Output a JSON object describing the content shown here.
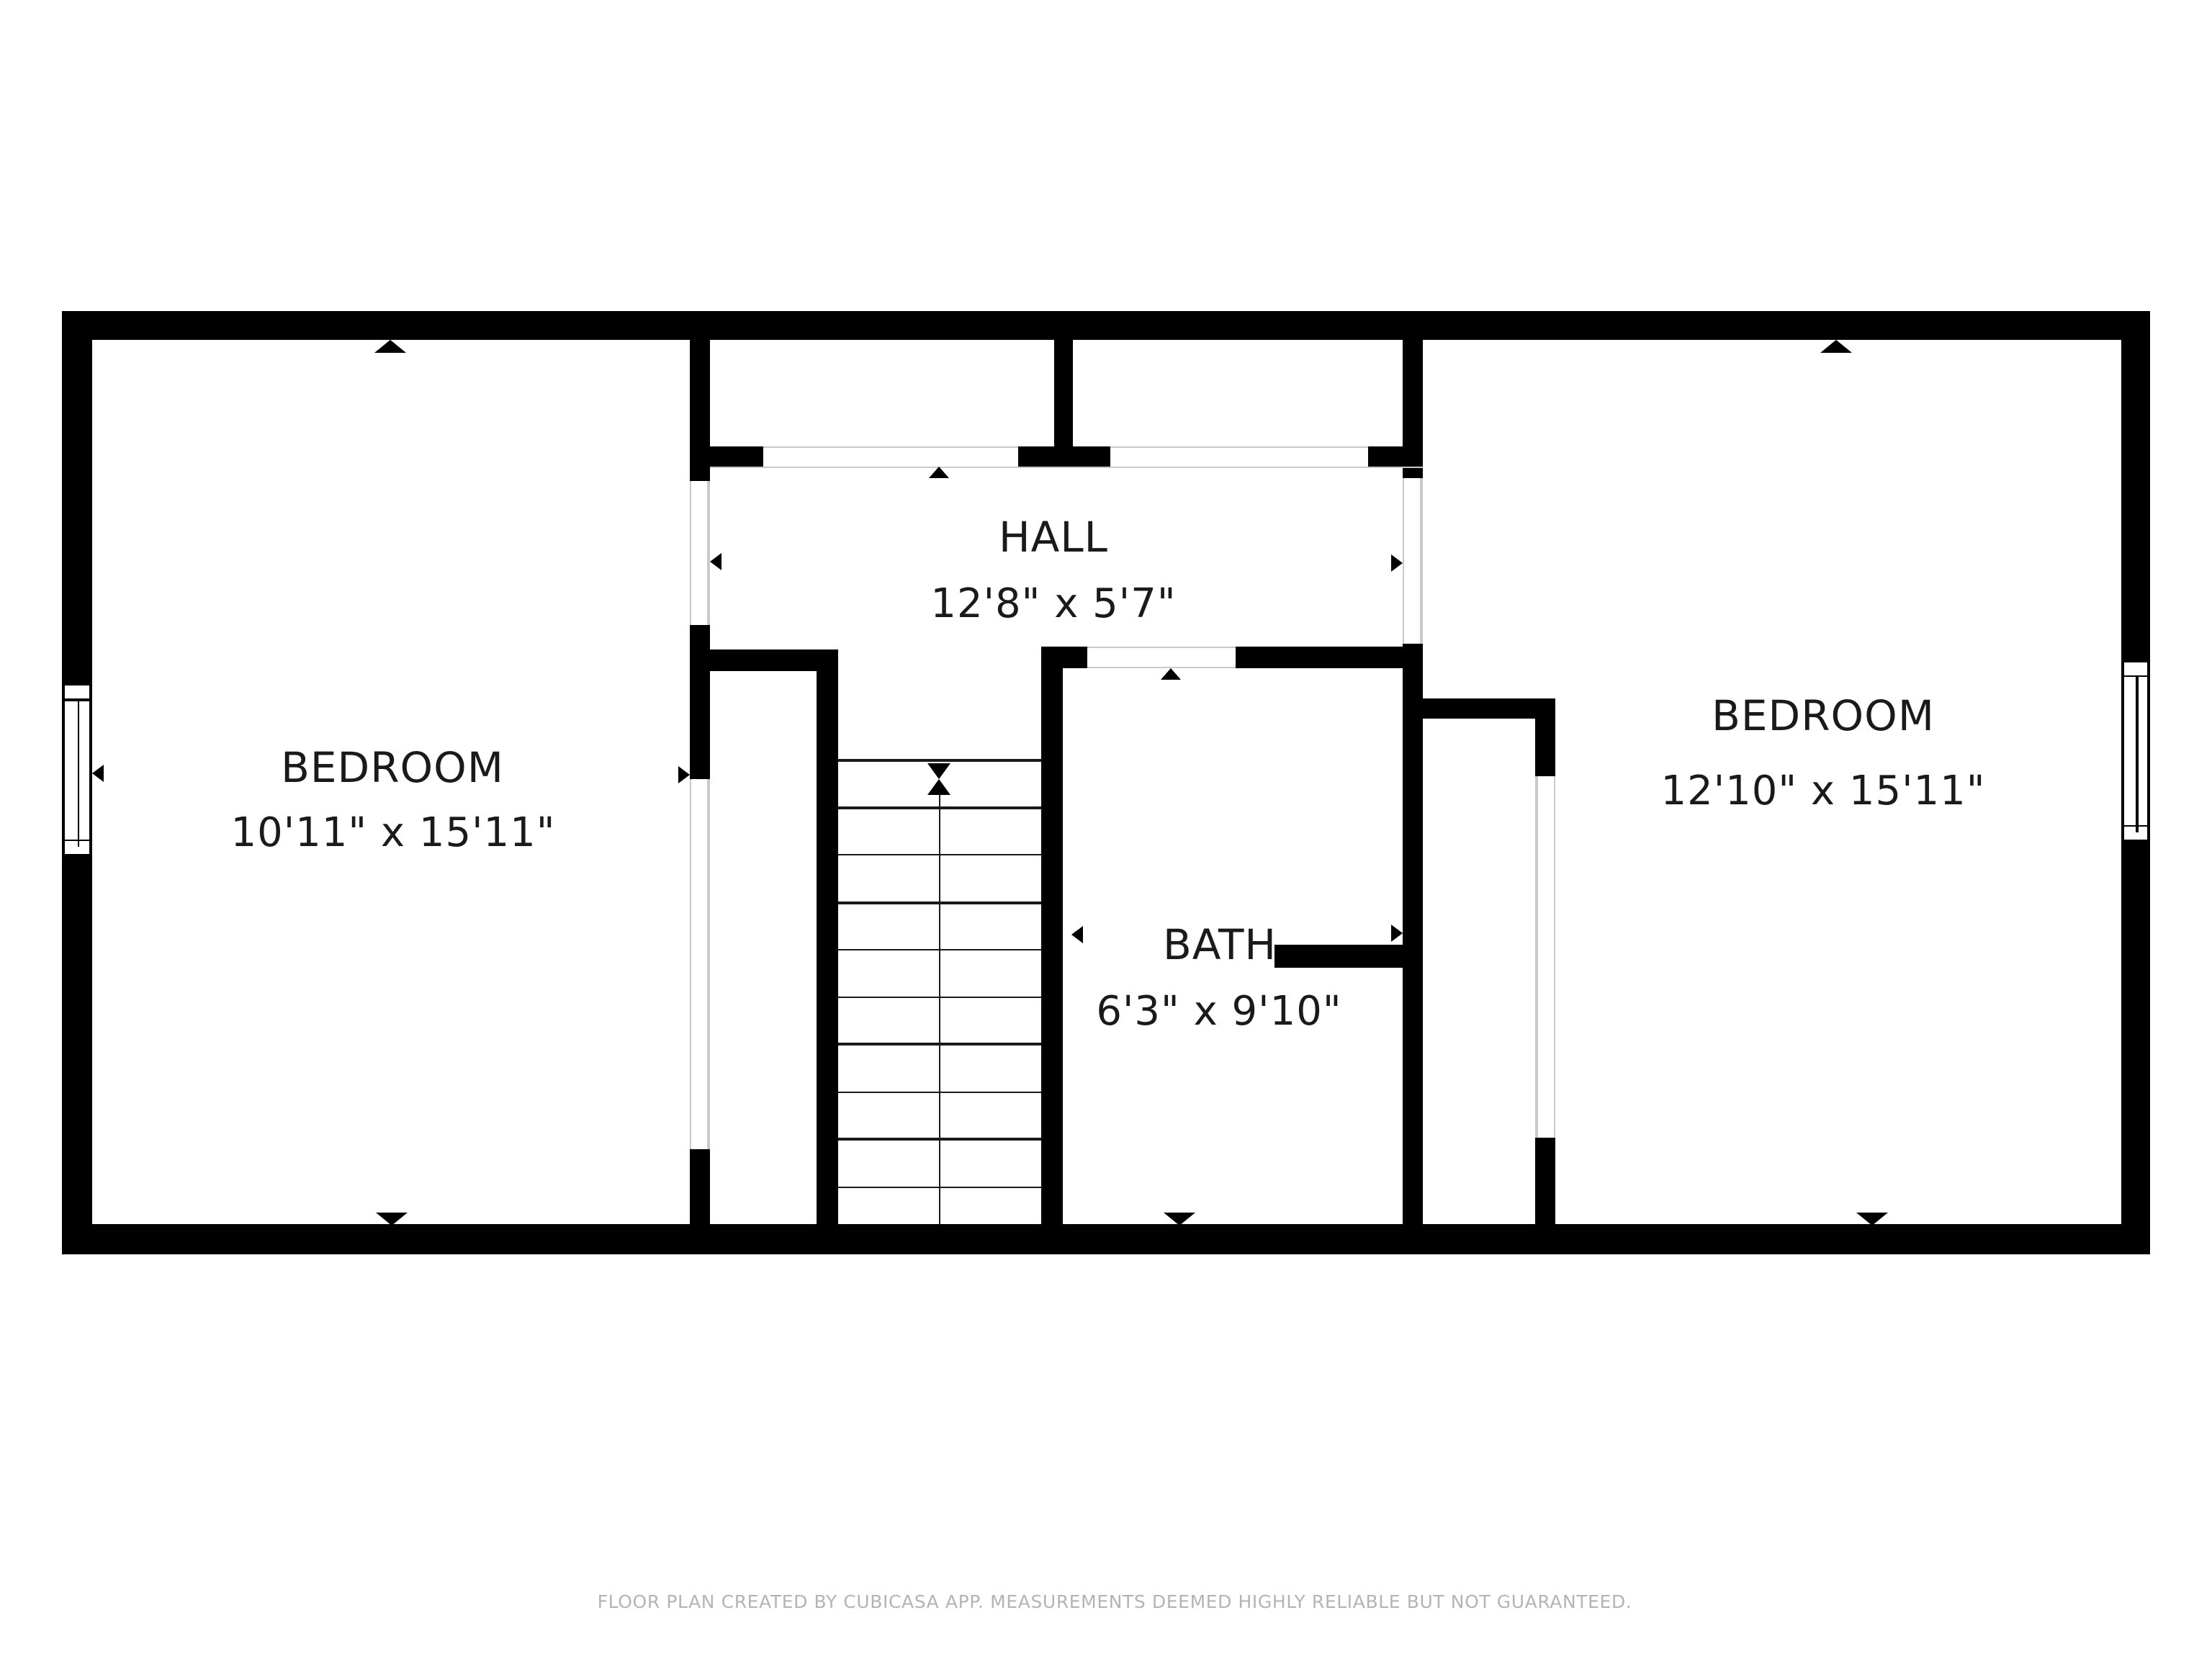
{
  "palette": {
    "wall_color": "#000000",
    "label_color": "#1a1a1a",
    "disclaimer_color": "#b4b4b4",
    "background": "#ffffff"
  },
  "rooms": [
    {
      "id": "bedroom-left",
      "name": "BEDROOM",
      "dims": "10'11\" x 15'11\""
    },
    {
      "id": "hall",
      "name": "HALL",
      "dims": "12'8\" x 5'7\""
    },
    {
      "id": "bath",
      "name": "BATH",
      "dims": "6'3\" x 9'10\""
    },
    {
      "id": "bedroom-right",
      "name": "BEDROOM",
      "dims": "12'10\" x 15'11\""
    }
  ],
  "footer": {
    "disclaimer": "FLOOR PLAN CREATED BY CUBICASA APP. MEASUREMENTS DEEMED HIGHLY RELIABLE BUT NOT GUARANTEED."
  }
}
